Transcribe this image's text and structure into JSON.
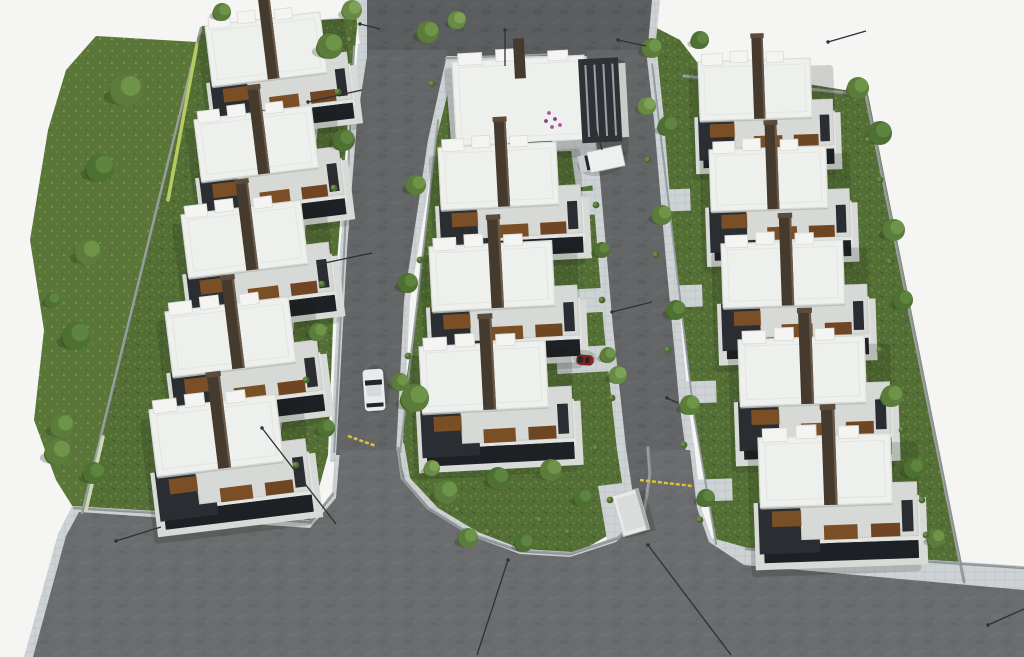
{
  "meta": {
    "alt": "Aerial 3D architectural rendering of a residential villa complex with three rows of white flat-roof houses, two access roads, lawns, trees and parked vehicles",
    "canvas": {
      "w": 1024,
      "h": 657
    }
  },
  "palette": {
    "bg": "#f5f5f3",
    "road": "#636567",
    "roadLight": "#6e7072",
    "roadDark": "#595b5d",
    "sidewalk": "#cdd2d4",
    "sidewalkLine": "#bfc4c6",
    "grass": "#546f36",
    "grassLight": "#6d8d46",
    "grassDark": "#40572a",
    "meadow": "#5a7739",
    "meadowLight": "#7d9c50",
    "wall": "#9aa0a2",
    "wallDark": "#82888a",
    "hedge": "#b6ca62",
    "hedgeWhite": "#cfd8b0",
    "roofWhite": "#eef0ed",
    "roofEdge": "#d9dbd7",
    "parapet": "#f4f5f3",
    "roofGray": "#d7d9d6",
    "concrete": "#c9ccc8",
    "facade": "#2a2d31",
    "glass": "#1d2024",
    "wood": "#7b4f26",
    "woodDark": "#6f4523",
    "chimney": "#453a2e",
    "chimneyCap": "#5a4b3b",
    "chimneyHi": "#6a5a47",
    "shadow": "rgba(22,28,20,0.17)",
    "carWhite": "#e9ecec",
    "carRed": "#8e1f1b",
    "truckWhite": "#eef0f0",
    "carGlass": "#22262b",
    "lamp": "#2e3032",
    "gate": "#d9c43a",
    "flowerA": "#b050a5",
    "flowerB": "#8e3b86",
    "kiosk": "#e8eae9",
    "kioskEdge": "#a9adaa",
    "treeTones": [
      [
        "#3f5a28",
        "#4f7033",
        "#5f8440"
      ],
      [
        "#49662e",
        "#5b7c3a",
        "#6e9449"
      ],
      [
        "#557338",
        "#688a44",
        "#7da257"
      ]
    ]
  },
  "scene": {
    "greens": [
      {
        "name": "west-meadow",
        "fill": "meadow",
        "pts": [
          96,
          36,
          197,
          42,
          175,
          130,
          152,
          240,
          130,
          340,
          105,
          440,
          88,
          502,
          76,
          512,
          56,
          480,
          34,
          420,
          44,
          330,
          30,
          240,
          48,
          130,
          66,
          70
        ]
      },
      {
        "name": "left-lots-lawn",
        "fill": "grass",
        "pts": [
          202,
          26,
          358,
          18,
          348,
          120,
          334,
          300,
          328,
          455,
          308,
          528,
          80,
          514
        ]
      },
      {
        "name": "center-lots-lawn",
        "fill": "grass",
        "pts": [
          446,
          54,
          578,
          54,
          592,
          160,
          606,
          300,
          622,
          440,
          640,
          452,
          642,
          500,
          624,
          526,
          576,
          554,
          518,
          548,
          464,
          527,
          424,
          504,
          401,
          472,
          396,
          450,
          418,
          300,
          436,
          140
        ]
      },
      {
        "name": "right-lots-lawn",
        "fill": "grass",
        "pts": [
          645,
          22,
          680,
          40,
          700,
          66,
          868,
          94,
          966,
          584,
          718,
          548,
          694,
          420,
          662,
          160,
          645,
          60
        ]
      }
    ],
    "paved": [
      {
        "name": "office-forecourt",
        "pts": [
          444,
          54,
          596,
          50,
          604,
          98,
          610,
          150,
          452,
          154
        ]
      },
      {
        "name": "truck-parking-bay",
        "pts": [
          564,
          96,
          602,
          92,
          612,
          182,
          576,
          188
        ]
      },
      {
        "name": "left-lane-path",
        "pts": [
          312,
          78,
          324,
          78,
          272,
          505,
          260,
          505
        ]
      },
      {
        "name": "kiosk-pad",
        "pts": [
          598,
          486,
          646,
          480,
          650,
          540,
          608,
          546
        ]
      }
    ],
    "sidewalks": [
      {
        "name": "top-road-sidewalk",
        "pts": [
          354,
          0,
          660,
          0,
          654,
          60,
          362,
          60
        ]
      },
      {
        "name": "west-road-sidewalk",
        "pts": [
          358,
          44,
          460,
          44,
          436,
          140,
          410,
          300,
          402,
          462,
          330,
          462,
          340,
          250,
          352,
          120
        ]
      },
      {
        "name": "east-road-sidewalk",
        "pts": [
          576,
          42,
          656,
          42,
          664,
          120,
          674,
          250,
          688,
          400,
          702,
          510,
          716,
          570,
          728,
          657,
          644,
          657,
          638,
          560,
          628,
          520,
          617,
          450,
          604,
          330,
          592,
          180,
          584,
          100
        ]
      },
      {
        "name": "south-road-sidewalk",
        "pts": [
          24,
          657,
          58,
          534,
          72,
          506,
          312,
          520,
          332,
          492,
          336,
          443,
          404,
          443,
          410,
          478,
          438,
          508,
          478,
          532,
          522,
          549,
          572,
          552,
          620,
          536,
          646,
          512,
          652,
          474,
          650,
          443,
          694,
          443,
          700,
          505,
          712,
          538,
          748,
          548,
          1024,
          566,
          1024,
          657
        ]
      }
    ],
    "roads": [
      {
        "name": "top-road",
        "shade": "dark",
        "pts": [
          367,
          0,
          652,
          0,
          647,
          56,
          367,
          56
        ]
      },
      {
        "name": "west-road",
        "shade": "none",
        "pts": [
          368,
          50,
          448,
          50,
          428,
          140,
          404,
          300,
          396,
          455,
          336,
          455,
          347,
          250,
          357,
          120
        ]
      },
      {
        "name": "east-road",
        "shade": "none",
        "pts": [
          586,
          50,
          646,
          50,
          654,
          120,
          665,
          250,
          679,
          400,
          693,
          505,
          706,
          560,
          718,
          657,
          654,
          657,
          646,
          555,
          636,
          515,
          626,
          448,
          613,
          328,
          600,
          178,
          591,
          98
        ]
      },
      {
        "name": "south-road",
        "shade": "light",
        "pts": [
          33,
          657,
          66,
          536,
          79,
          512,
          310,
          528,
          336,
          498,
          340,
          450,
          398,
          450,
          405,
          480,
          432,
          512,
          474,
          537,
          520,
          554,
          570,
          557,
          616,
          542,
          642,
          518,
          648,
          478,
          646,
          450,
          690,
          450,
          697,
          508,
          709,
          542,
          744,
          565,
          1024,
          590,
          1024,
          657
        ]
      }
    ],
    "walls": [
      {
        "name": "west-boundary-wall",
        "pts": [
          201,
          28,
          82,
          513
        ],
        "w": 2.5
      },
      {
        "name": "south-left-wall",
        "pts": [
          74,
          508,
          310,
          522,
          333,
          494
        ],
        "w": 2.5
      },
      {
        "name": "north-east-wall",
        "pts": [
          684,
          76,
          866,
          95
        ],
        "w": 3
      },
      {
        "name": "east-boundary-wall",
        "pts": [
          866,
          95,
          964,
          582
        ],
        "w": 3
      },
      {
        "name": "left-lots-fence",
        "pts": [
          354,
          46,
          334,
          452
        ],
        "w": 1.8
      },
      {
        "name": "center-lots-fence",
        "pts": [
          438,
          120,
          400,
          452
        ],
        "w": 1.8
      },
      {
        "name": "right-lots-fence",
        "pts": [
          652,
          64,
          694,
          416,
          716,
          544
        ],
        "w": 1.8
      },
      {
        "name": "green-arc-wall",
        "pts": [
          398,
          448,
          402,
          478,
          428,
          508,
          470,
          534,
          520,
          551,
          570,
          554,
          618,
          538,
          644,
          514,
          650,
          474,
          648,
          448
        ],
        "w": 3
      },
      {
        "name": "office-lot-wall",
        "pts": [
          446,
          58,
          560,
          54,
          596,
          66,
          604,
          96
        ],
        "w": 2
      },
      {
        "name": "south-east-wall",
        "pts": [
          746,
          549,
          1024,
          568
        ],
        "w": 2.5
      }
    ],
    "hedges": [
      {
        "name": "yellow-hedge",
        "color": "hedge",
        "pts": [
          197,
          44,
          168,
          200
        ],
        "w": 3.5
      },
      {
        "name": "white-flowering-hedge",
        "color": "hedgeWhite",
        "pts": [
          103,
          437,
          86,
          510
        ],
        "w": 3.5
      }
    ],
    "gates": [
      [
        348,
        436,
        376,
        446
      ],
      [
        640,
        480,
        692,
        486
      ]
    ],
    "walkpads": [
      [
        306,
        88,
        42,
        20,
        -7
      ],
      [
        296,
        184,
        42,
        20,
        -7
      ],
      [
        286,
        278,
        44,
        20,
        -7
      ],
      [
        274,
        374,
        44,
        20,
        -7
      ],
      [
        262,
        464,
        46,
        20,
        -7
      ],
      [
        566,
        192,
        46,
        24,
        -3
      ],
      [
        562,
        290,
        48,
        24,
        -3
      ],
      [
        556,
        348,
        54,
        26,
        -3
      ],
      [
        650,
        190,
        40,
        22,
        -2
      ],
      [
        660,
        286,
        42,
        22,
        -2
      ],
      [
        672,
        382,
        44,
        22,
        -2
      ],
      [
        686,
        480,
        46,
        22,
        -2
      ]
    ],
    "houses": [
      {
        "x": 205,
        "y": 26,
        "rot": -7,
        "s": 0.98
      },
      {
        "x": 194,
        "y": 120,
        "rot": -7,
        "s": 1.0
      },
      {
        "x": 181,
        "y": 215,
        "rot": -7,
        "s": 1.02
      },
      {
        "x": 165,
        "y": 312,
        "rot": -7,
        "s": 1.05
      },
      {
        "x": 149,
        "y": 410,
        "rot": -7,
        "s": 1.08
      },
      {
        "x": 438,
        "y": 148,
        "rot": -3,
        "s": 1.0
      },
      {
        "x": 429,
        "y": 247,
        "rot": -3,
        "s": 1.04
      },
      {
        "x": 419,
        "y": 347,
        "rot": -3,
        "s": 1.07
      },
      {
        "x": 698,
        "y": 62,
        "rot": -2,
        "s": 0.95
      },
      {
        "x": 709,
        "y": 150,
        "rot": -2,
        "s": 0.99
      },
      {
        "x": 721,
        "y": 244,
        "rot": -2,
        "s": 1.03
      },
      {
        "x": 738,
        "y": 340,
        "rot": -2,
        "s": 1.07
      },
      {
        "x": 758,
        "y": 438,
        "rot": -2,
        "s": 1.12
      }
    ],
    "office": {
      "x": 452,
      "y": 62,
      "rot": -3
    },
    "kiosk": {
      "x": 612,
      "y": 496,
      "w": 27,
      "h": 42,
      "rot": -16
    },
    "vehicles": [
      {
        "kind": "car",
        "color": "carWhite",
        "x": 374,
        "y": 390,
        "l": 42,
        "w": 21,
        "rot": -94
      },
      {
        "kind": "car",
        "color": "carRed",
        "x": 585,
        "y": 360,
        "l": 17,
        "w": 10,
        "rot": -175
      },
      {
        "kind": "truck",
        "color": "truckWhite",
        "x": 601,
        "y": 160,
        "l": 45,
        "w": 21,
        "rot": -12
      }
    ],
    "trees": [
      [
        126,
        90,
        16,
        1
      ],
      [
        100,
        168,
        14,
        0
      ],
      [
        88,
        252,
        13,
        1
      ],
      [
        76,
        336,
        14,
        0
      ],
      [
        62,
        426,
        12,
        1
      ],
      [
        94,
        473,
        11,
        0
      ],
      [
        52,
        300,
        8,
        0
      ],
      [
        330,
        46,
        13,
        1
      ],
      [
        222,
        12,
        9,
        1
      ],
      [
        344,
        140,
        11,
        0
      ],
      [
        318,
        332,
        9,
        1
      ],
      [
        326,
        428,
        9,
        0
      ],
      [
        352,
        10,
        10,
        2
      ],
      [
        415,
        398,
        14,
        1
      ],
      [
        428,
        32,
        11,
        1
      ],
      [
        457,
        20,
        9,
        2
      ],
      [
        416,
        185,
        10,
        1
      ],
      [
        408,
        283,
        10,
        0
      ],
      [
        400,
        382,
        9,
        1
      ],
      [
        602,
        250,
        8,
        0
      ],
      [
        608,
        355,
        8,
        1
      ],
      [
        618,
        375,
        9,
        2
      ],
      [
        446,
        492,
        12,
        1
      ],
      [
        498,
        478,
        11,
        0
      ],
      [
        551,
        470,
        11,
        1
      ],
      [
        583,
        498,
        9,
        0
      ],
      [
        468,
        538,
        10,
        1
      ],
      [
        524,
        543,
        9,
        0
      ],
      [
        432,
        468,
        8,
        2
      ],
      [
        652,
        48,
        10,
        1
      ],
      [
        668,
        126,
        10,
        0
      ],
      [
        647,
        106,
        9,
        2
      ],
      [
        662,
        215,
        10,
        1
      ],
      [
        676,
        310,
        10,
        0
      ],
      [
        690,
        405,
        10,
        1
      ],
      [
        706,
        498,
        9,
        0
      ],
      [
        858,
        88,
        11,
        1
      ],
      [
        880,
        133,
        12,
        0
      ],
      [
        894,
        230,
        11,
        1
      ],
      [
        903,
        300,
        10,
        0
      ],
      [
        892,
        396,
        11,
        1
      ],
      [
        914,
        468,
        10,
        0
      ],
      [
        936,
        538,
        9,
        1
      ],
      [
        700,
        40,
        9,
        0
      ],
      [
        58,
        452,
        13,
        1
      ]
    ],
    "shrubs": [
      [
        338,
        92
      ],
      [
        334,
        188
      ],
      [
        322,
        284
      ],
      [
        306,
        380
      ],
      [
        296,
        465
      ],
      [
        432,
        84
      ],
      [
        420,
        260
      ],
      [
        408,
        356
      ],
      [
        596,
        205
      ],
      [
        602,
        300
      ],
      [
        612,
        398
      ],
      [
        648,
        160
      ],
      [
        656,
        255
      ],
      [
        668,
        350
      ],
      [
        684,
        445
      ],
      [
        700,
        520
      ],
      [
        880,
        180
      ],
      [
        890,
        262
      ],
      [
        880,
        350
      ],
      [
        902,
        430
      ],
      [
        922,
        500
      ],
      [
        458,
        510
      ],
      [
        488,
        532
      ],
      [
        540,
        520
      ],
      [
        568,
        532
      ],
      [
        610,
        500
      ],
      [
        350,
        40
      ],
      [
        596,
        448
      ],
      [
        926,
        535
      ],
      [
        868,
        140
      ]
    ],
    "lamps": [
      [
        308,
        102,
        362,
        90
      ],
      [
        320,
        264,
        372,
        253
      ],
      [
        262,
        428,
        336,
        524
      ],
      [
        593,
        119,
        602,
        150
      ],
      [
        612,
        312,
        652,
        302
      ],
      [
        648,
        545,
        731,
        655
      ],
      [
        988,
        625,
        1024,
        609
      ],
      [
        828,
        42,
        866,
        31
      ],
      [
        116,
        541,
        161,
        527
      ],
      [
        508,
        560,
        477,
        655
      ],
      [
        667,
        398,
        678,
        403
      ],
      [
        360,
        24,
        380,
        29
      ],
      [
        618,
        40,
        646,
        46
      ],
      [
        505,
        30,
        505,
        66
      ]
    ],
    "flowers": [
      [
        549,
        113
      ],
      [
        555,
        119
      ],
      [
        560,
        125
      ],
      [
        546,
        121
      ],
      [
        552,
        127
      ]
    ]
  }
}
